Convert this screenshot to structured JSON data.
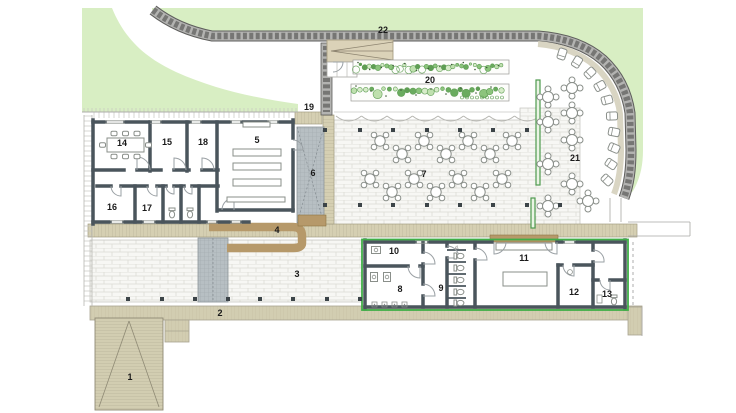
{
  "plan": {
    "kind": "architectural-site-floor-plan",
    "room_labels": [
      "1",
      "2",
      "3",
      "4",
      "5",
      "6",
      "7",
      "8",
      "9",
      "10",
      "11",
      "12",
      "13",
      "14",
      "15",
      "16",
      "17",
      "18",
      "19",
      "20",
      "21",
      "22"
    ],
    "note_label": "d.",
    "colors": {
      "grass": "#d8eec3",
      "stone": "#b3b3b1",
      "stone_dark": "#767674",
      "stone_edge": "#5e5e5c",
      "brick_bg": "#f7f7f4",
      "brick_joint": "#dcdcd5",
      "wood": "#d5cfb2",
      "wood_hatch": "#b9b298",
      "path": "#d2cdb1",
      "counter": "#b6996a",
      "wall": "#4a555c",
      "outline_green": "#3fae47",
      "ramp": "#b7bfc3",
      "planter_green": "#4e9a4e",
      "label": "#1a1a1a",
      "plant_palette": [
        "#bfe0ae",
        "#8cc47c",
        "#5f9e54",
        "#d7ecc9",
        "#6aab5e"
      ]
    }
  }
}
